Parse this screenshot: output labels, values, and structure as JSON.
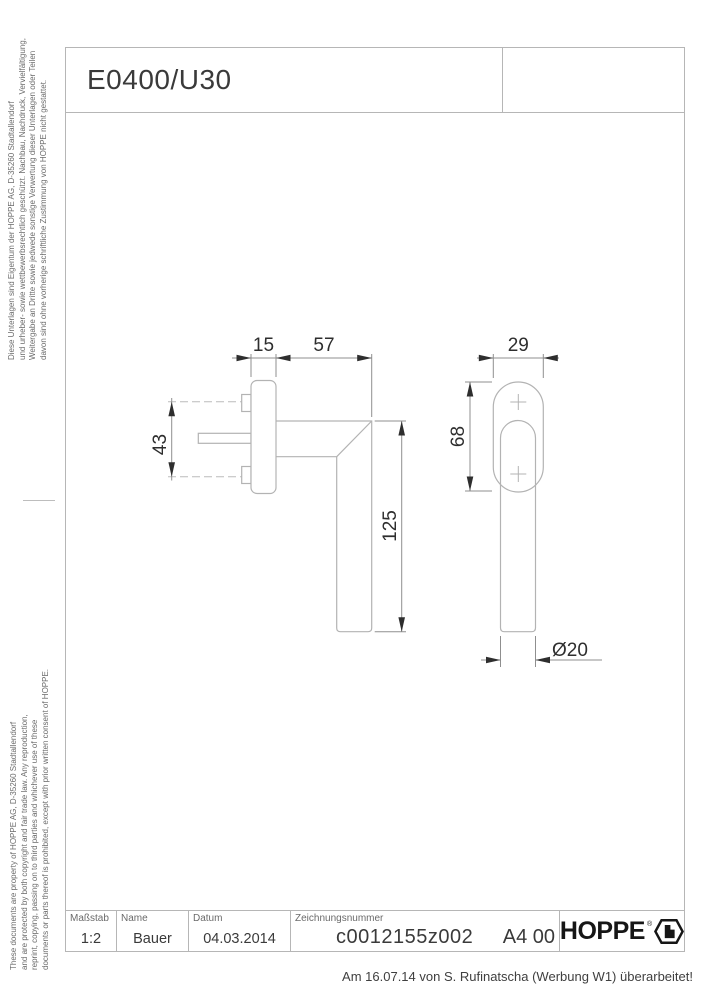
{
  "page": {
    "title": "E0400/U30",
    "revision_note": "Am 16.07.14 von S. Rufinatscha (Werbung W1) überarbeitet!"
  },
  "margin_notes": {
    "german": {
      "lines": [
        "Diese Unterlagen sind Eigentum der  HOPPE AG, D-35260 Stadtallendorf",
        "und urheber- sowie wettbewerbsrechtlich geschützt. Nachbau, Nachdruck, Vervielfältigung,",
        "Weitergabe an Dritte sowie jedwede sonstige Verwertung dieser Unterlagen oder Teilen",
        "davon sind ohne vorherige schriftliche Zustimmung von HOPPE nicht gestattet."
      ]
    },
    "english": {
      "lines": [
        "These documents are property of HOPPE AG, D-35260 Stadtallendorf",
        "and are protected by both copyright and fair trade law. Any reproduction,",
        "reprint, copying, passing on to third parties and whichever use of these",
        "documents or parts thereof is prohibited, except with prior written consent of HOPPE."
      ]
    }
  },
  "title_block": {
    "scale": {
      "label": "Maßstab",
      "value": "1:2"
    },
    "name": {
      "label": "Name",
      "value": "Bauer"
    },
    "date": {
      "label": "Datum",
      "value": "04.03.2014"
    },
    "drawing_number": {
      "label": "Zeichnungsnummer",
      "value": "c0012155z002"
    },
    "format": "A4 00",
    "brand": "HOPPE",
    "brand_mark": "®"
  },
  "drawing": {
    "views": [
      "side-view",
      "front-view"
    ],
    "dimensions": {
      "plate_thickness": "15",
      "grip_offset": "57",
      "rosette_width": "29",
      "screw_distance": "43",
      "rosette_height": "68",
      "grip_length": "125",
      "grip_diameter": "Ø20"
    }
  },
  "colors": {
    "frame_line": "#b6b6b6",
    "part_outline": "#b3b3b3",
    "dimension_line": "#8f8f8f",
    "dimension_text": "#2e2e2e",
    "brand": "#161616"
  }
}
